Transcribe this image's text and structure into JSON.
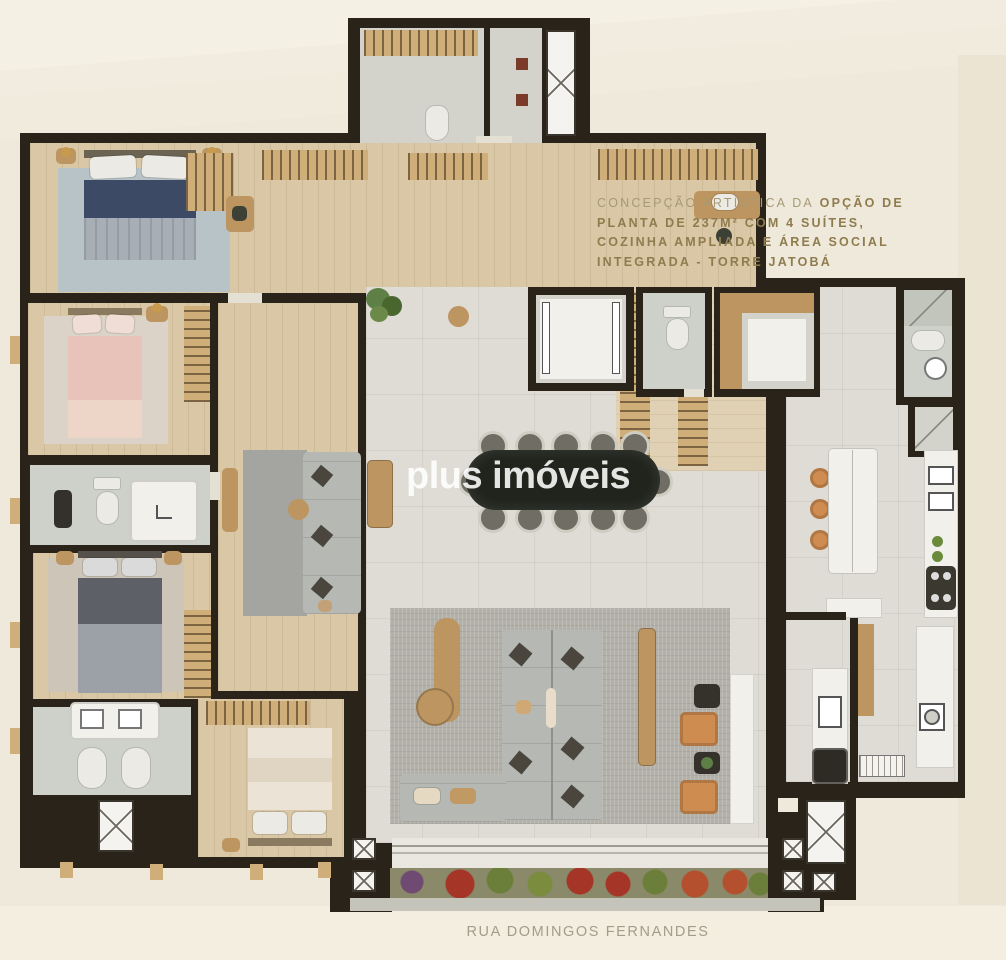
{
  "annotation": {
    "lead": "CONCEPÇÃO ARTÍSTICA DA",
    "line1_bold": "OPÇÃO DE",
    "line2": "PLANTA DE 237M² COM 4 SUÍTES,",
    "line3": "COZINHA AMPLIADA E ÁREA SOCIAL",
    "line4": "INTEGRADA - TORRE JATOBÁ"
  },
  "watermark": "plus imóveis",
  "street_label": "RUA DOMINGOS FERNANDES",
  "palette": {
    "bg": "#efe9db",
    "bg-light": "#f5f0e4",
    "bg-bottom": "#f3eee0",
    "bg-right": "#ece4d3",
    "wall": "#29231a",
    "wood": "#bd9560",
    "wood-light": "#cfae7a",
    "wood-floor": "#d9c7a6",
    "tile": "#dedcd5",
    "bath": "#cdd1c9",
    "white-fix": "#f1f0ea",
    "gray-floor": "#d3d3cb",
    "rug-gray": "#b2b0a8",
    "rug-blue": "#b7c3c6",
    "navy": "#3d4a66",
    "blanket": "#a7aeb6",
    "pink": "#e7c3ba",
    "grey-bed": "#5d6167",
    "cream-bed": "#eae3d6",
    "sofa": "#b6b8b4",
    "orange": "#cf8c50",
    "table": "#20241d",
    "chair": "#6f6d64",
    "chair-rim": "#cfcdc2",
    "gold": "#a89a75",
    "gold-bold": "#8f7c4e",
    "street": "#a59c89",
    "watermark": "rgba(255,255,255,.88)",
    "plant": "#5e7f45",
    "flower-red": "#a53527",
    "flower-rust": "#b4502e",
    "flower-purple": "#6f4a72",
    "concrete": "#c5c4ba"
  }
}
